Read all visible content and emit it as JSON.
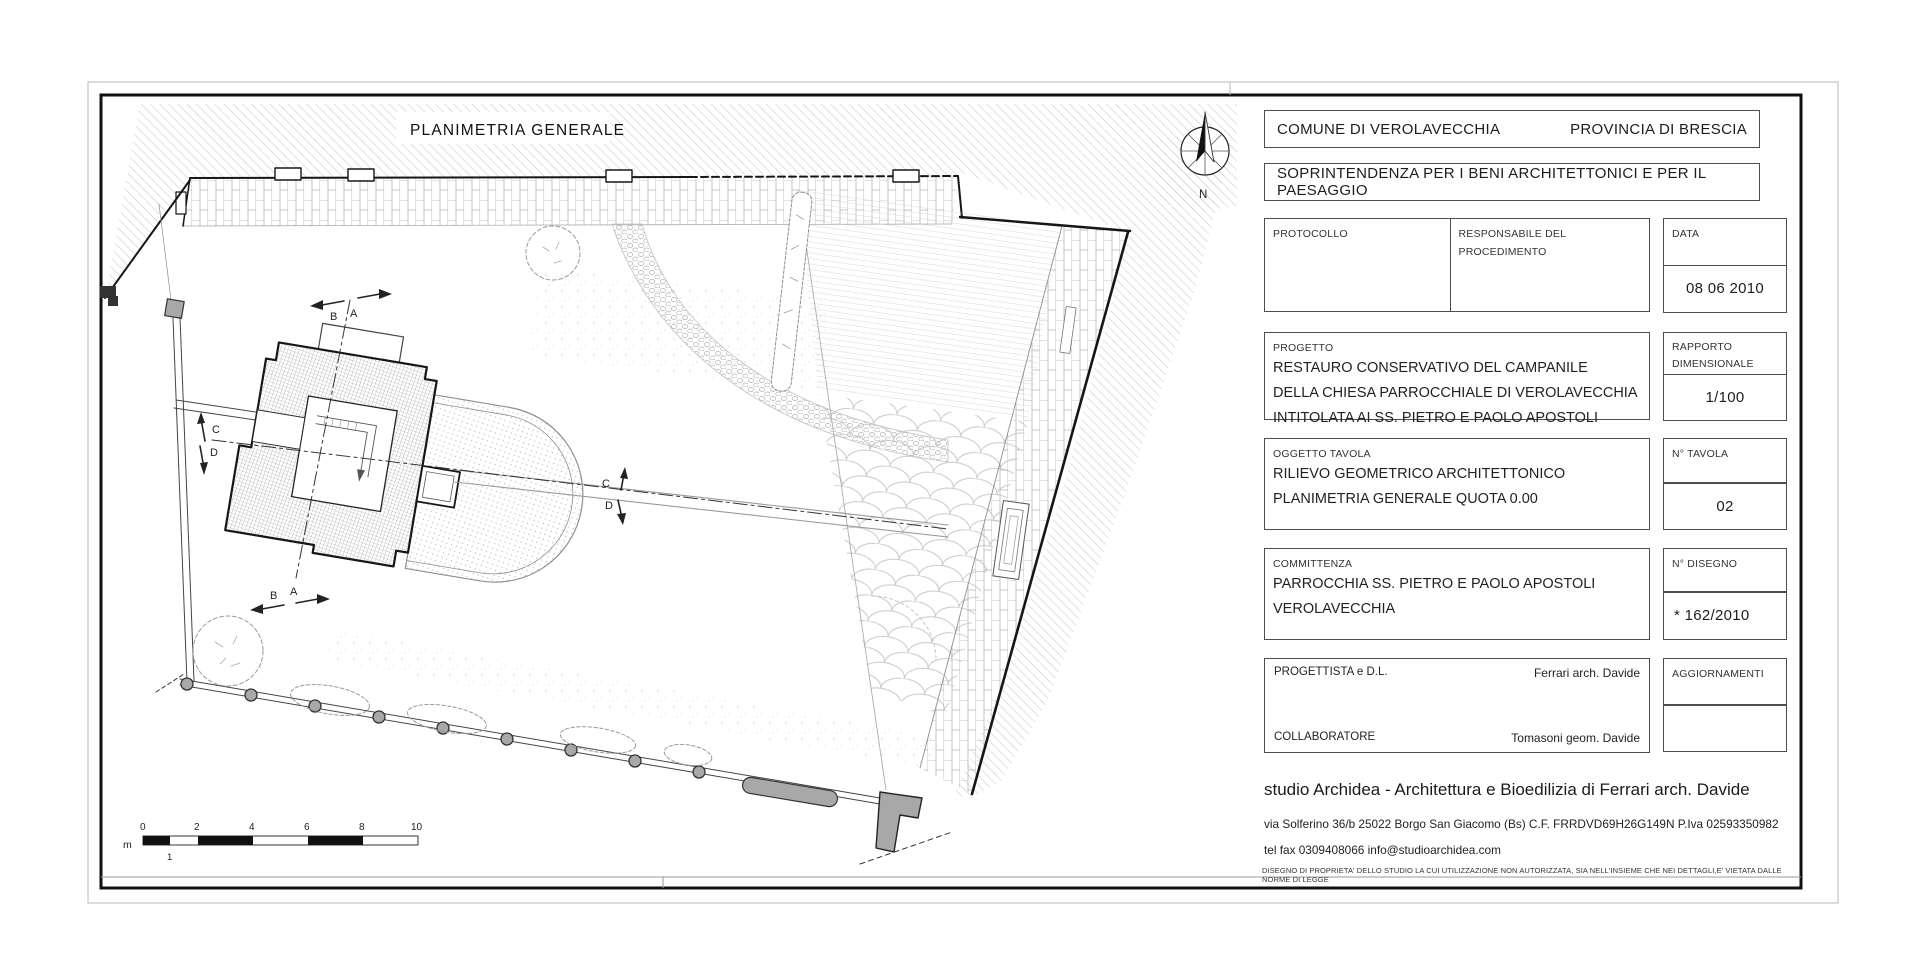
{
  "plan": {
    "title": "PLANIMETRIA GENERALE",
    "north": "N",
    "sections": {
      "b": "B",
      "a": "A",
      "c": "C",
      "d": "D"
    },
    "scale": {
      "unit": "m",
      "ticks": [
        "0",
        "2",
        "4",
        "6",
        "8",
        "10"
      ],
      "half": "1"
    }
  },
  "tb": {
    "comune": "COMUNE DI VEROLAVECCHIA",
    "provincia": "PROVINCIA DI BRESCIA",
    "soprintendenza": "SOPRINTENDENZA PER I BENI ARCHITETTONICI E PER IL PAESAGGIO",
    "protocollo_label": "PROTOCOLLO",
    "responsabile_label": "RESPONSABILE DEL PROCEDIMENTO",
    "data_label": "DATA",
    "data_value": "08 06 2010",
    "progetto_label": "PROGETTO",
    "progetto_lines": {
      "0": "RESTAURO CONSERVATIVO DEL CAMPANILE",
      "1": "DELLA  CHIESA PARROCCHIALE DI VEROLAVECCHIA",
      "2": "INTITOLATA AI SS. PIETRO E PAOLO APOSTOLI"
    },
    "rapporto_label_1": "RAPPORTO",
    "rapporto_label_2": "DIMENSIONALE",
    "rapporto_value": "1/100",
    "oggetto_label": "OGGETTO TAVOLA",
    "oggetto_lines": {
      "0": "RILIEVO GEOMETRICO ARCHITETTONICO",
      "1": "PLANIMETRIA GENERALE QUOTA 0.00"
    },
    "tavola_label": "N° TAVOLA",
    "tavola_value": "02",
    "committenza_label": "COMMITTENZA",
    "committenza_lines": {
      "0": "PARROCCHIA SS. PIETRO E PAOLO APOSTOLI",
      "1": "VEROLAVECCHIA"
    },
    "disegno_label": "N° DISEGNO",
    "disegno_value": "* 162/2010",
    "progettista_label": "PROGETTISTA e D.L.",
    "progettista_value": "Ferrari arch. Davide",
    "collaboratore_label": "COLLABORATORE",
    "collaboratore_value": "Tomasoni geom. Davide",
    "aggiornamenti_label": "AGGIORNAMENTI",
    "studio_line": "studio Archidea - Architettura e Bioedilizia di Ferrari arch. Davide",
    "address_line": "via Solferino 36/b  25022  Borgo San Giacomo  (Bs)  C.F. FRRDVD69H26G149N  P.Iva  02593350982",
    "contact_line": "tel  fax  0309408066  info@studioarchidea.com",
    "disclaimer": "DISEGNO DI PROPRIETA' DELLO STUDIO LA CUI UTILIZZAZIONE NON AUTORIZZATA, SIA NELL'INSIEME CHE NEI DETTAGLI,E' VIETATA DALLE NORME DI LEGGE"
  },
  "colors": {
    "ink": "#1a1a1a",
    "box_border": "#4d4d4d",
    "pattern": "#c0c0c0",
    "gray_fill": "#9c9c9c"
  }
}
